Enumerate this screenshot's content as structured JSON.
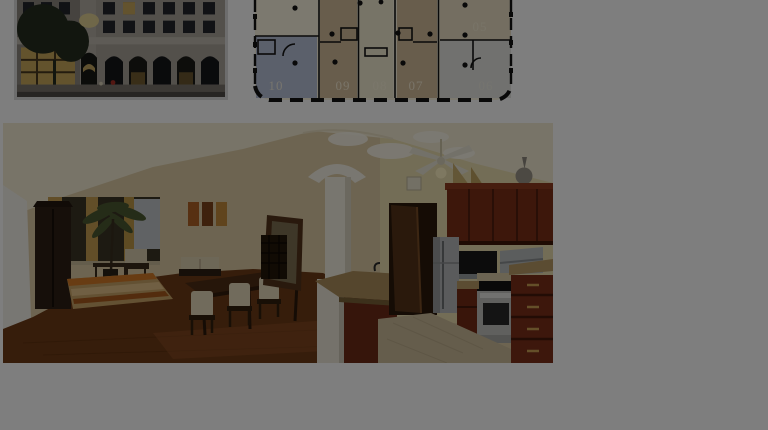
{
  "window": {
    "width": 768,
    "height": 430
  },
  "lightbox": {
    "overlay_color": "rgba(0,0,0,0.506)"
  },
  "gallery": {
    "thumb_building": {
      "semantic": "building-exterior-photo-at-dusk"
    },
    "thumb_floorplan": {
      "semantic": "residential-floor-plan-drawing"
    },
    "main_panorama": {
      "semantic": "loft-interior-panorama-living-dining-kitchen"
    }
  },
  "floor_plan": {
    "unit_labels": [
      "10",
      "09",
      "08",
      "07"
    ],
    "unit_label_top_right": "05",
    "unit_label_far_right": "06",
    "colors": {
      "background": "#faf4e0",
      "unit_blue": "#b9c2d8",
      "unit_taupe": "#d3bd9b",
      "unit_cream": "#f1ead0",
      "rooms_gray": "#e4e5e1",
      "room_tan": "#eadfc4",
      "walls": "#141414",
      "label_ink": "#fdf6e0"
    }
  }
}
